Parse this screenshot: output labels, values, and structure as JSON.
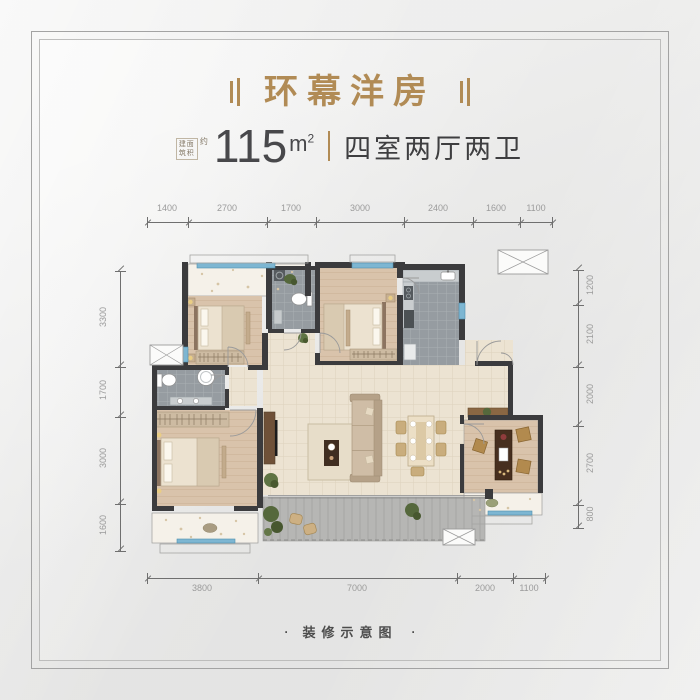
{
  "header": {
    "title": "环幕洋房",
    "area_label_line1": "建面",
    "area_label_line2": "筑积",
    "area_approx": "约",
    "area_value": "115",
    "area_unit_base": "m",
    "area_unit_sup": "2",
    "room_spec": "四室两厅两卫"
  },
  "dimensions": {
    "top": [
      "1400",
      "2700",
      "1700",
      "3000",
      "2400",
      "1600",
      "1100"
    ],
    "left": [
      "3300",
      "1700",
      "3000",
      "1600"
    ],
    "right": [
      "1200",
      "2100",
      "2000",
      "2700",
      "800"
    ],
    "bottom": [
      "3800",
      "7000",
      "2000",
      "1100"
    ]
  },
  "footer": {
    "dot_left": "·",
    "caption": "装修示意图",
    "dot_right": "·"
  },
  "colors": {
    "accent": "#b18b55",
    "text_primary": "#48484b",
    "dim_text": "#9b9b9b",
    "wall": "#3b3b3d",
    "window_blue": "#7db6d2"
  }
}
